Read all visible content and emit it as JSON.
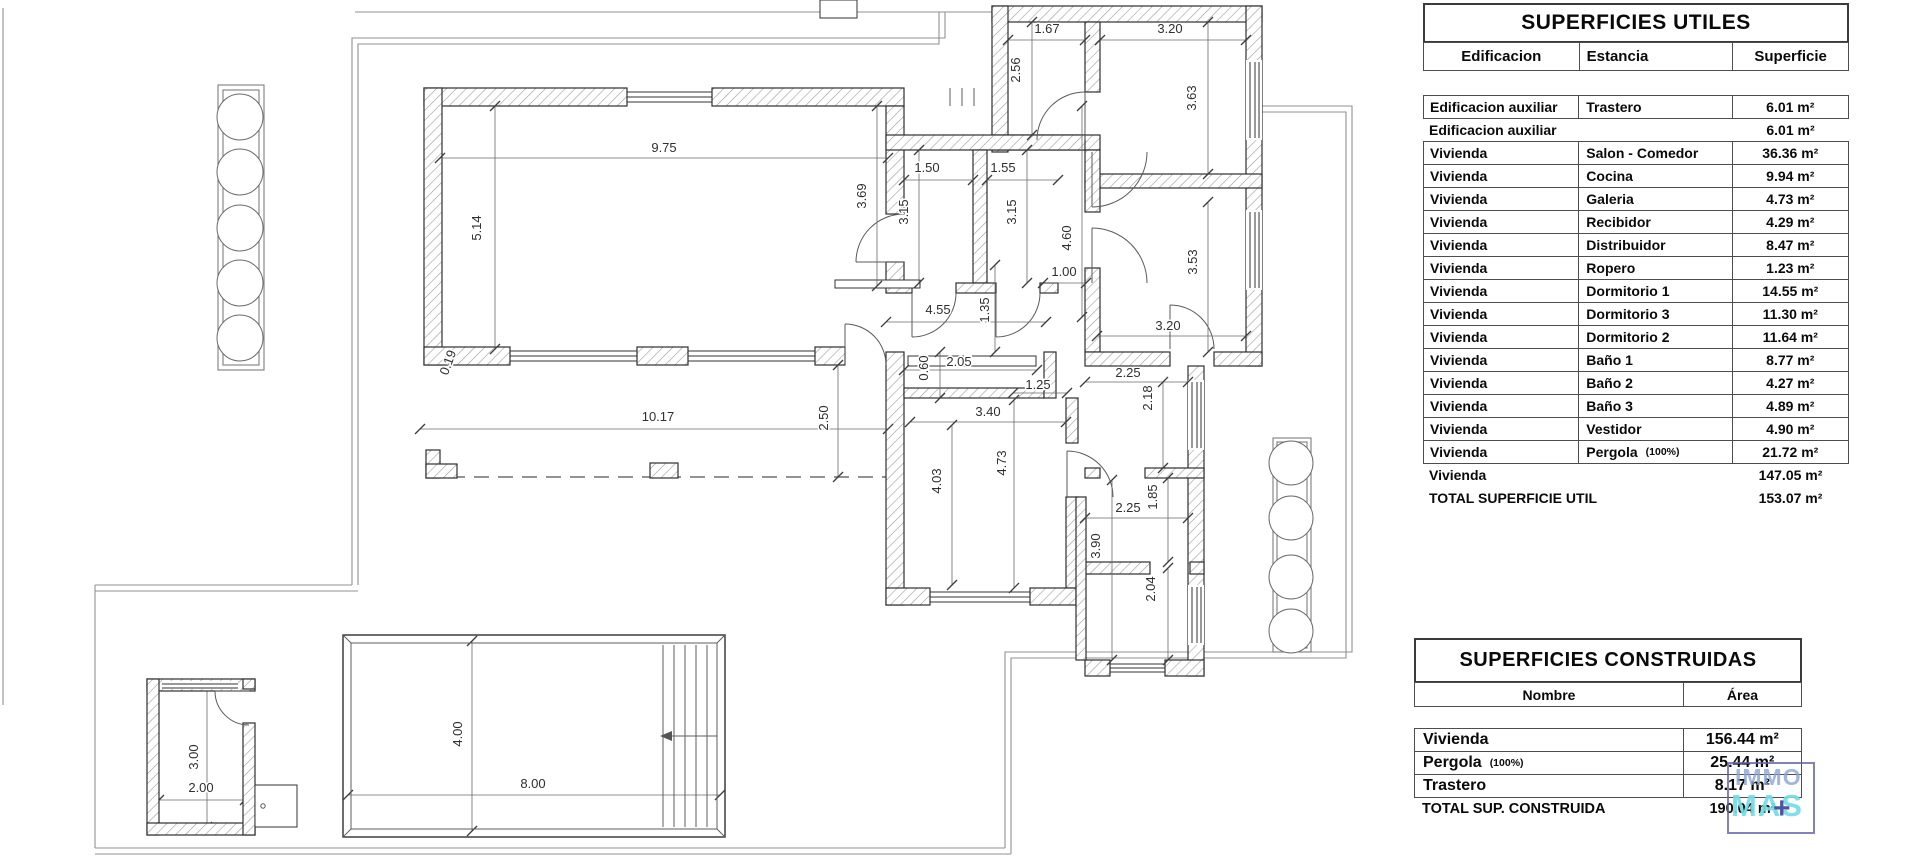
{
  "plan": {
    "dims": [
      {
        "t": "9.75",
        "x": 664,
        "y": 152,
        "r": 0
      },
      {
        "t": "5.14",
        "x": 481,
        "y": 228,
        "r": -90
      },
      {
        "t": "0.19",
        "x": 452,
        "y": 364,
        "r": -70
      },
      {
        "t": "1.67",
        "x": 1047,
        "y": 33,
        "r": 0
      },
      {
        "t": "2.56",
        "x": 1020,
        "y": 70,
        "r": -90
      },
      {
        "t": "3.20",
        "x": 1170,
        "y": 33,
        "r": 0
      },
      {
        "t": "3.63",
        "x": 1196,
        "y": 98,
        "r": -90
      },
      {
        "t": "1.50",
        "x": 927,
        "y": 172,
        "r": 0
      },
      {
        "t": "1.55",
        "x": 1003,
        "y": 172,
        "r": 0
      },
      {
        "t": "3.69",
        "x": 866,
        "y": 196,
        "r": -90
      },
      {
        "t": "3.15",
        "x": 908,
        "y": 212,
        "r": -90
      },
      {
        "t": "3.15",
        "x": 1016,
        "y": 212,
        "r": -90
      },
      {
        "t": "4.60",
        "x": 1071,
        "y": 238,
        "r": -90
      },
      {
        "t": "1.00",
        "x": 1064,
        "y": 276,
        "r": 0
      },
      {
        "t": "4.55",
        "x": 938,
        "y": 314,
        "r": 0
      },
      {
        "t": "1.35",
        "x": 989,
        "y": 310,
        "r": -90
      },
      {
        "t": "3.53",
        "x": 1197,
        "y": 262,
        "r": -90
      },
      {
        "t": "3.20",
        "x": 1168,
        "y": 330,
        "r": 0
      },
      {
        "t": "0.60",
        "x": 928,
        "y": 368,
        "r": -90
      },
      {
        "t": "2.05",
        "x": 959,
        "y": 366,
        "r": 0
      },
      {
        "t": "1.25",
        "x": 1038,
        "y": 389,
        "r": 0
      },
      {
        "t": "2.25",
        "x": 1128,
        "y": 377,
        "r": 0
      },
      {
        "t": "2.18",
        "x": 1152,
        "y": 398,
        "r": -90
      },
      {
        "t": "3.40",
        "x": 988,
        "y": 416,
        "r": 0
      },
      {
        "t": "10.17",
        "x": 658,
        "y": 421,
        "r": 0
      },
      {
        "t": "2.50",
        "x": 828,
        "y": 418,
        "r": -90
      },
      {
        "t": "4.03",
        "x": 941,
        "y": 481,
        "r": -90
      },
      {
        "t": "4.73",
        "x": 1006,
        "y": 463,
        "r": -90
      },
      {
        "t": "1.85",
        "x": 1157,
        "y": 497,
        "r": -90
      },
      {
        "t": "2.25",
        "x": 1128,
        "y": 512,
        "r": 0
      },
      {
        "t": "3.90",
        "x": 1100,
        "y": 546,
        "r": -90
      },
      {
        "t": "2.04",
        "x": 1155,
        "y": 589,
        "r": -90
      },
      {
        "t": "3.00",
        "x": 198,
        "y": 757,
        "r": -90
      },
      {
        "t": "2.00",
        "x": 201,
        "y": 792,
        "r": 0
      },
      {
        "t": "4.00",
        "x": 462,
        "y": 734,
        "r": -90
      },
      {
        "t": "8.00",
        "x": 533,
        "y": 788,
        "r": 0
      }
    ]
  },
  "tables": {
    "utiles": {
      "title": "SUPERFICIES UTILES",
      "columns": [
        "Edificacion",
        "Estancia",
        "Superficie"
      ],
      "rows": [
        {
          "edificacion": "Edificacion auxiliar",
          "estancia": "Trastero",
          "nota": "",
          "superficie": "6.01 m²",
          "boxed": true
        },
        {
          "edificacion": "Edificacion auxiliar",
          "estancia": "",
          "nota": "",
          "superficie": "6.01 m²",
          "boxed": false
        },
        {
          "edificacion": "Vivienda",
          "estancia": "Salon - Comedor",
          "nota": "",
          "superficie": "36.36 m²",
          "boxed": true
        },
        {
          "edificacion": "Vivienda",
          "estancia": "Cocina",
          "nota": "",
          "superficie": "9.94 m²",
          "boxed": true
        },
        {
          "edificacion": "Vivienda",
          "estancia": "Galeria",
          "nota": "",
          "superficie": "4.73 m²",
          "boxed": true
        },
        {
          "edificacion": "Vivienda",
          "estancia": "Recibidor",
          "nota": "",
          "superficie": "4.29 m²",
          "boxed": true
        },
        {
          "edificacion": "Vivienda",
          "estancia": "Distribuidor",
          "nota": "",
          "superficie": "8.47 m²",
          "boxed": true
        },
        {
          "edificacion": "Vivienda",
          "estancia": "Ropero",
          "nota": "",
          "superficie": "1.23 m²",
          "boxed": true
        },
        {
          "edificacion": "Vivienda",
          "estancia": "Dormitorio 1",
          "nota": "",
          "superficie": "14.55 m²",
          "boxed": true
        },
        {
          "edificacion": "Vivienda",
          "estancia": "Dormitorio 3",
          "nota": "",
          "superficie": "11.30 m²",
          "boxed": true
        },
        {
          "edificacion": "Vivienda",
          "estancia": "Dormitorio 2",
          "nota": "",
          "superficie": "11.64 m²",
          "boxed": true
        },
        {
          "edificacion": "Vivienda",
          "estancia": "Baño 1",
          "nota": "",
          "superficie": "8.77 m²",
          "boxed": true
        },
        {
          "edificacion": "Vivienda",
          "estancia": "Baño 2",
          "nota": "",
          "superficie": "4.27 m²",
          "boxed": true
        },
        {
          "edificacion": "Vivienda",
          "estancia": "Baño 3",
          "nota": "",
          "superficie": "4.89 m²",
          "boxed": true
        },
        {
          "edificacion": "Vivienda",
          "estancia": "Vestidor",
          "nota": "",
          "superficie": "4.90 m²",
          "boxed": true
        },
        {
          "edificacion": "Vivienda",
          "estancia": "Pergola",
          "nota": "(100%)",
          "superficie": "21.72 m²",
          "boxed": true
        }
      ],
      "totals": [
        {
          "label": "Vivienda",
          "value": "147.05 m²"
        },
        {
          "label": "TOTAL SUPERFICIE UTIL",
          "value": "153.07 m²"
        }
      ]
    },
    "construidas": {
      "title": "SUPERFICIES CONSTRUIDAS",
      "columns": [
        "Nombre",
        "Área"
      ],
      "rows": [
        {
          "nombre": "Vivienda",
          "nota": "",
          "area": "156.44 m²"
        },
        {
          "nombre": "Pergola",
          "nota": "(100%)",
          "area": "25.44 m²"
        },
        {
          "nombre": "Trastero",
          "nota": "",
          "area": "8.17 m²"
        }
      ],
      "total": {
        "label": "TOTAL SUP. CONSTRUIDA",
        "value": "190.04 m²"
      }
    }
  },
  "watermark": {
    "line1": "IMMO",
    "line2": "MAS",
    "plus": "+",
    "border_color": "#6663a8",
    "line1_color": "#8ba3d6",
    "line2_color": "#74dce6",
    "plus_color": "#46499b"
  }
}
